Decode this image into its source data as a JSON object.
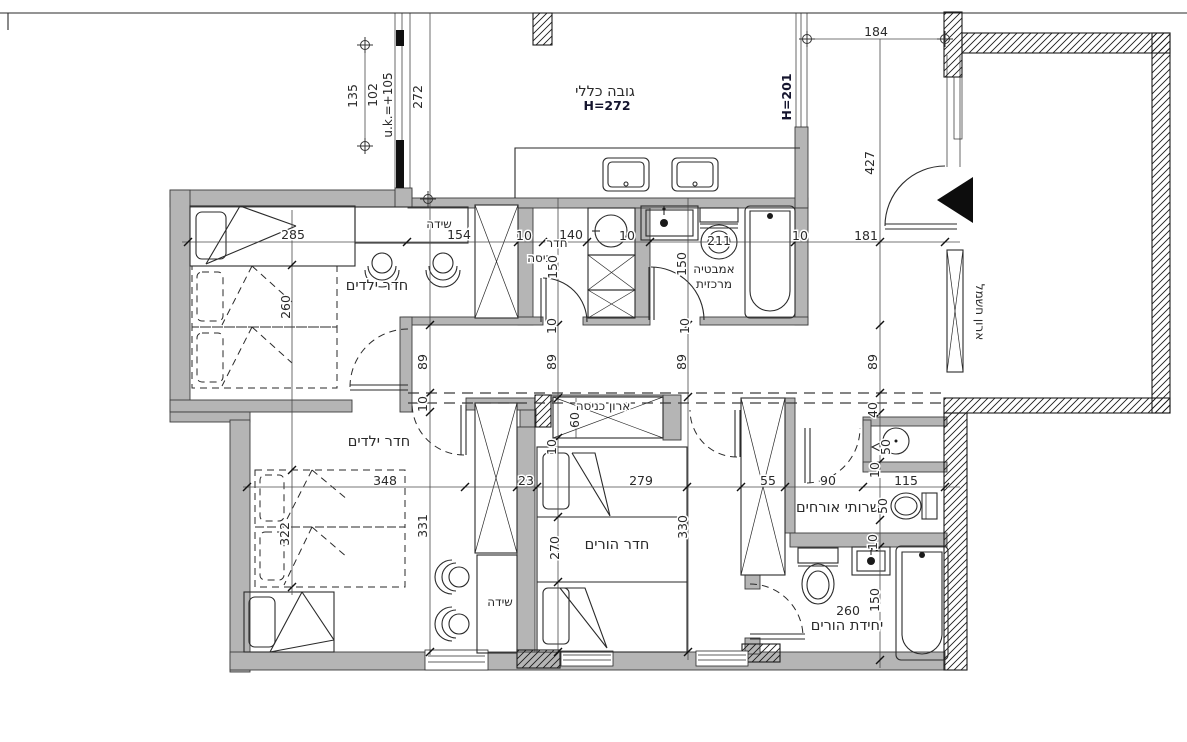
{
  "drawing": {
    "type": "apartment floor plan",
    "colors": {
      "wall_fill": "#b5b5b5",
      "line": "#2a2a2a",
      "text": "#2a2a2a",
      "bold_text": "#15152e",
      "background": "#ffffff"
    },
    "labels": {
      "general_height": "גובה כללי",
      "general_height_value": "H=272",
      "window_height": "H=201",
      "sill_level": "u.k.=+105",
      "kids_room": "חדר ילדים",
      "parents_room": "חדר הורים",
      "laundry_line1": "חדר",
      "laundry_line2": "כביסה",
      "central_bath_line1": "אמבטיה",
      "central_bath_line2": "מרכזית",
      "entry_closet": "ארון כניסה",
      "electric_cabinet": "ארון חשמל",
      "guest_wc": "שרותי אורחים",
      "parents_unit": "יחידת הורים",
      "dresser": "שידה"
    },
    "dims": {
      "d135": "135",
      "d102": "102",
      "d272": "272",
      "d184": "184",
      "d427": "427",
      "d181": "181",
      "d285": "285",
      "d260": "260",
      "d154": "154",
      "d140": "140",
      "d150": "150",
      "d211": "211",
      "d89": "89",
      "d10": "10",
      "d40": "40",
      "d50": "50",
      "d90": "90",
      "d115": "115",
      "d348": "348",
      "d23": "23",
      "d279": "279",
      "d55": "55",
      "d331": "331",
      "d322": "322",
      "d270": "270",
      "d330": "330",
      "d60": "60"
    }
  }
}
